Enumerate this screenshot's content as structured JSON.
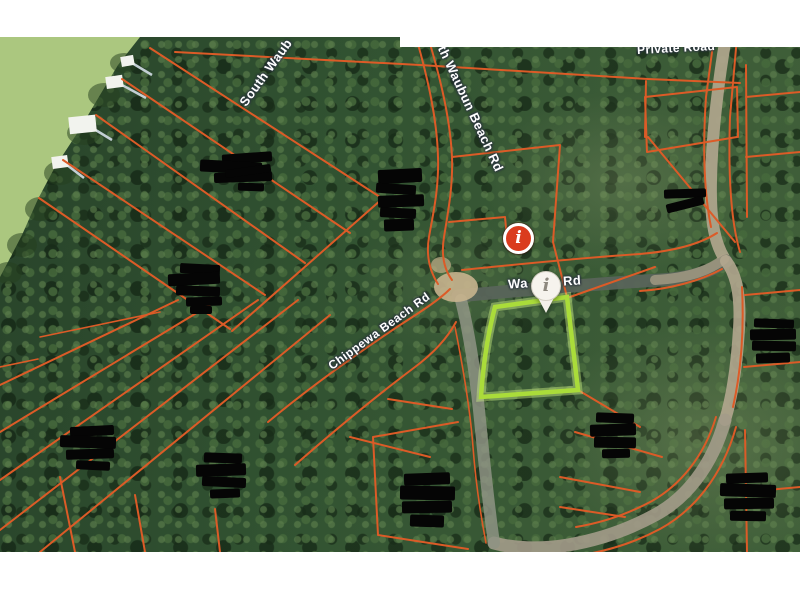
{
  "map": {
    "title": "aerial parcel map with highlighted lot",
    "road_labels": {
      "south_waubun_partial": "South Waub",
      "waubun_beach_rd_partial": "th Waubun Beach Rd",
      "private_road": "Private Road",
      "chippewa_beach_rd": "Chippewa Beach Rd",
      "waubun_rd_left": "Wa",
      "waubun_rd_right": "Rd"
    },
    "markers": {
      "red_info": {
        "glyph": "i",
        "fill": "#da3b1e",
        "ring": "#ffffff"
      },
      "white_pin": {
        "glyph": "i",
        "fill": "#f6f3ed",
        "glyph_color": "#8d887e"
      }
    },
    "colors": {
      "highlight_parcel": "#aadc3a",
      "highlight_glow": "rgba(205,240,130,0.45)",
      "parcel_line": "#dc5b27",
      "water": "#abc77f",
      "road_dark": "#58645a",
      "road_tan": "#b3a78f"
    },
    "redactions": [
      {
        "bars": [
          [
            222,
            116,
            50,
            10,
            -4
          ],
          [
            200,
            124,
            62,
            12,
            3
          ],
          [
            214,
            135,
            58,
            10,
            -2
          ],
          [
            225,
            130,
            46,
            8,
            -8
          ],
          [
            238,
            146,
            26,
            8,
            2
          ]
        ]
      },
      {
        "bars": [
          [
            378,
            132,
            44,
            14,
            -3
          ],
          [
            376,
            147,
            40,
            10,
            4
          ],
          [
            378,
            158,
            46,
            12,
            -2
          ],
          [
            380,
            171,
            36,
            10,
            3
          ],
          [
            384,
            182,
            30,
            12,
            -2
          ]
        ]
      },
      {
        "bars": [
          [
            180,
            227,
            40,
            10,
            3
          ],
          [
            168,
            236,
            52,
            12,
            -3
          ],
          [
            176,
            249,
            44,
            10,
            2
          ],
          [
            186,
            260,
            36,
            9,
            -2
          ],
          [
            190,
            269,
            22,
            8,
            0
          ]
        ]
      },
      {
        "bars": [
          [
            664,
            152,
            42,
            9,
            -2
          ],
          [
            666,
            163,
            38,
            9,
            -14
          ]
        ]
      },
      {
        "bars": [
          [
            70,
            389,
            44,
            10,
            -3
          ],
          [
            60,
            399,
            56,
            12,
            2
          ],
          [
            66,
            412,
            48,
            10,
            -2
          ],
          [
            76,
            424,
            34,
            9,
            3
          ]
        ]
      },
      {
        "bars": [
          [
            204,
            416,
            38,
            10,
            2
          ],
          [
            196,
            427,
            50,
            12,
            -2
          ],
          [
            202,
            440,
            44,
            10,
            3
          ],
          [
            210,
            452,
            30,
            9,
            -2
          ]
        ]
      },
      {
        "bars": [
          [
            404,
            436,
            46,
            12,
            -2
          ],
          [
            400,
            449,
            55,
            14,
            1
          ],
          [
            402,
            464,
            50,
            12,
            -1
          ],
          [
            410,
            478,
            34,
            12,
            2
          ]
        ]
      },
      {
        "bars": [
          [
            596,
            376,
            38,
            10,
            2
          ],
          [
            590,
            387,
            46,
            12,
            -2
          ],
          [
            594,
            400,
            42,
            11,
            1
          ],
          [
            602,
            412,
            28,
            9,
            -1
          ]
        ]
      },
      {
        "bars": [
          [
            726,
            436,
            42,
            10,
            -2
          ],
          [
            720,
            447,
            56,
            13,
            2
          ],
          [
            724,
            461,
            50,
            11,
            -1
          ],
          [
            730,
            474,
            36,
            10,
            1
          ]
        ]
      },
      {
        "bars": [
          [
            754,
            282,
            40,
            9,
            2
          ],
          [
            750,
            292,
            46,
            11,
            -1
          ],
          [
            752,
            304,
            44,
            10,
            1
          ],
          [
            756,
            316,
            34,
            10,
            -2
          ]
        ]
      }
    ]
  }
}
